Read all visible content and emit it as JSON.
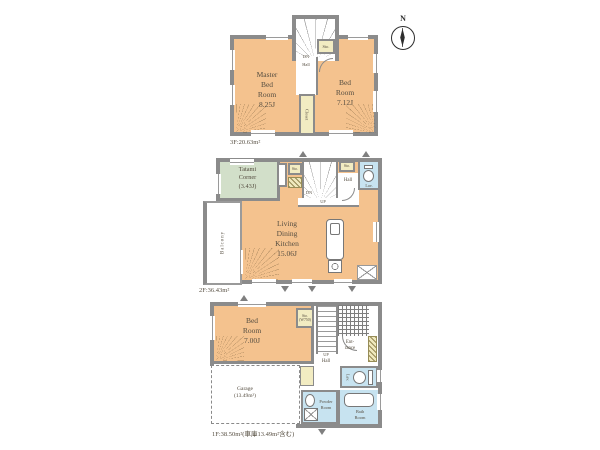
{
  "compass": {
    "north": "N"
  },
  "colors": {
    "wall": "#8b8b8b",
    "room_peach": "#f4c28e",
    "tatami_green": "#d2dfc9",
    "wet_blue": "#c7e3f0",
    "storage_yellow": "#f2ecc2"
  },
  "floor3": {
    "area": "3F:20.63m²",
    "master": "Master\nBed\nRoom\n8.25J",
    "bed": "Bed\nRoom\n7.12J",
    "sto": "Sto.",
    "dn": "DN",
    "hall": "Hall",
    "closet": "Closet"
  },
  "floor2": {
    "area": "2F:36.43m²",
    "tatami": "Tatami\nCorner\n(3.43J)",
    "ldk": "Living\nDining\nKitchen\n15.06J",
    "balcony": "Balcony",
    "sto1": "Sto.",
    "sto2": "Sto.",
    "dn": "DN",
    "up": "UP",
    "hall": "Hall",
    "lav": "Lav."
  },
  "floor1": {
    "area": "1F:38.50m²(車庫13.49m²含む)",
    "bed": "Bed\nRoom\n7.00J",
    "sto": "Sto.\n(W750)",
    "up": "UP",
    "entrance": "Ent-\nrance",
    "hall": "Hall",
    "lav": "Lav.",
    "powder": "Powder\nRoom",
    "bath": "Bath\nRoom",
    "garage": "Garage\n(13.49m²)"
  }
}
